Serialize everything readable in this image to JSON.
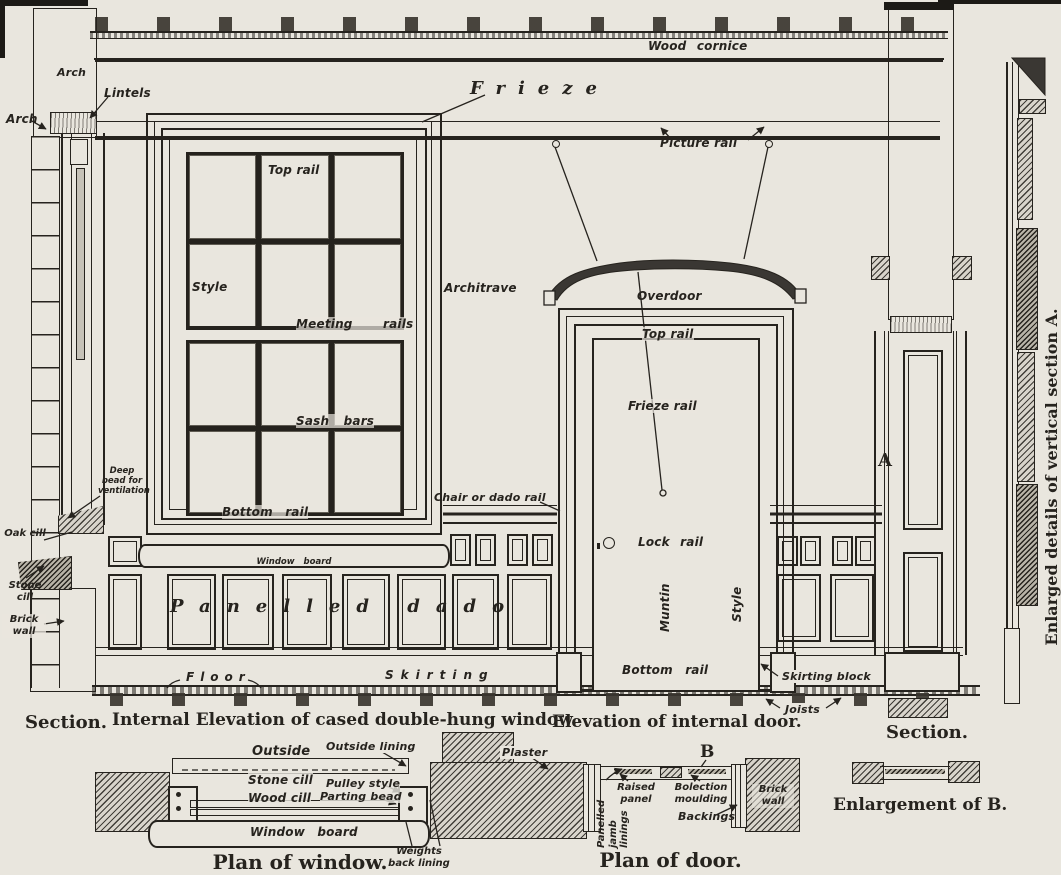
{
  "colors": {
    "paper": "#e9e6de",
    "ink": "#26231e",
    "hatch": "#d8d4cb"
  },
  "elevation": {
    "ceiling": {
      "wood_cornice": "Wood cornice",
      "frieze": "Frieze",
      "picture_rail": "Picture rail"
    },
    "left_section": {
      "arch_wall": "Arch",
      "arch": "Arch",
      "lintels": "Lintels",
      "oak_cill": "Oak cill",
      "stone_cill": "Stone cill",
      "brick_wall": "Brick wall",
      "caption": "Section."
    },
    "window": {
      "top_rail": "Top rail",
      "style": "Style",
      "meeting_rails": "Meeting rails",
      "sash_bars": "Sash bars",
      "bottom_rail": "Bottom rail",
      "architrave": "Architrave",
      "deep_bead": "Deep bead for ventilation",
      "window_board": "Window board",
      "caption": "Internal Elevation of cased double-hung window."
    },
    "dado": {
      "chair_rail": "Chair or dado rail",
      "panelled_dado": "Panelled dado",
      "floor": "Floor",
      "skirting": "Skirting"
    },
    "door": {
      "overdoor": "Overdoor",
      "top_rail": "Top rail",
      "frieze_rail": "Frieze rail",
      "lock_rail": "Lock rail",
      "muntin": "Muntin",
      "style": "Style",
      "bottom_rail": "Bottom rail",
      "skirting_block": "Skirting block",
      "joists": "Joists",
      "caption": "Elevation of internal door."
    },
    "right_section": {
      "a_marker": "A",
      "caption": "Section.",
      "enlarged_note": "Enlarged details of vertical section A."
    }
  },
  "plan_window": {
    "outside": "Outside",
    "outside_lining": "Outside lining",
    "stone_cill": "Stone cill",
    "pulley_style": "Pulley style",
    "wood_cill": "Wood cill",
    "parting_bead": "Parting bead",
    "window_board": "Window board",
    "weights_back_lining": "Weights back lining",
    "caption": "Plan of window."
  },
  "plan_door": {
    "plaster": "Plaster",
    "b_marker": "B",
    "raised_panel": "Raised panel",
    "bolection_moulding": "Bolection moulding",
    "panelled_jamb_linings": "Panelled jamb linings",
    "backings": "Backings",
    "brick_wall": "Brick wall",
    "caption": "Plan of door."
  },
  "enlargement_b": {
    "caption": "Enlargement of B."
  }
}
